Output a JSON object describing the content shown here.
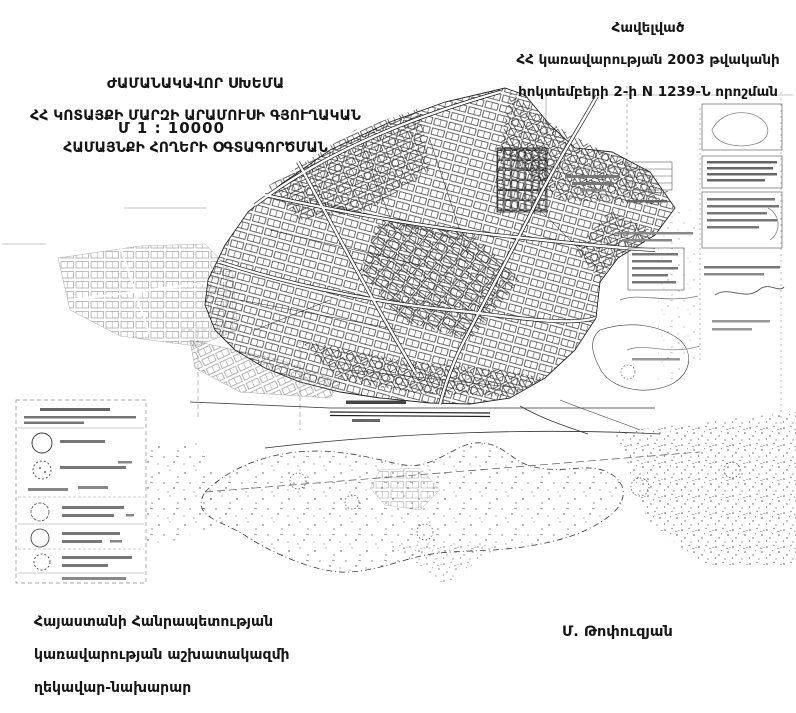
{
  "colors": {
    "ink": "#1a1a1a",
    "paper": "#ffffff",
    "faint": "#777777"
  },
  "appendix": {
    "lines": [
      "Հավելված",
      "ՀՀ կառավարության 2003 թվականի",
      "հոկտեմբերի 2-ի N 1239-Ն որոշման"
    ]
  },
  "title": {
    "lines": [
      "ԺԱՄԱՆԱԿԱՎՈՐ ՍԽԵՄԱ",
      "ՀՀ ԿՈՏԱՅՔԻ ՄԱՐԶԻ ԱՐԱՄՈՒՍԻ ԳՅՈՒՂԱԿԱՆ",
      "ՀԱՄԱՅՆՔԻ ՀՈՂԵՐԻ ՕԳՏԱԳՈՐԾՄԱՆ"
    ],
    "scale": "Մ 1 : 10000"
  },
  "footer": {
    "official_lines": [
      "Հայաստանի Հանրապետության",
      "կառավարության աշխատակազմի",
      "ղեկավար-նախարար"
    ],
    "signature_name": "Մ. Թոփուզյան"
  }
}
